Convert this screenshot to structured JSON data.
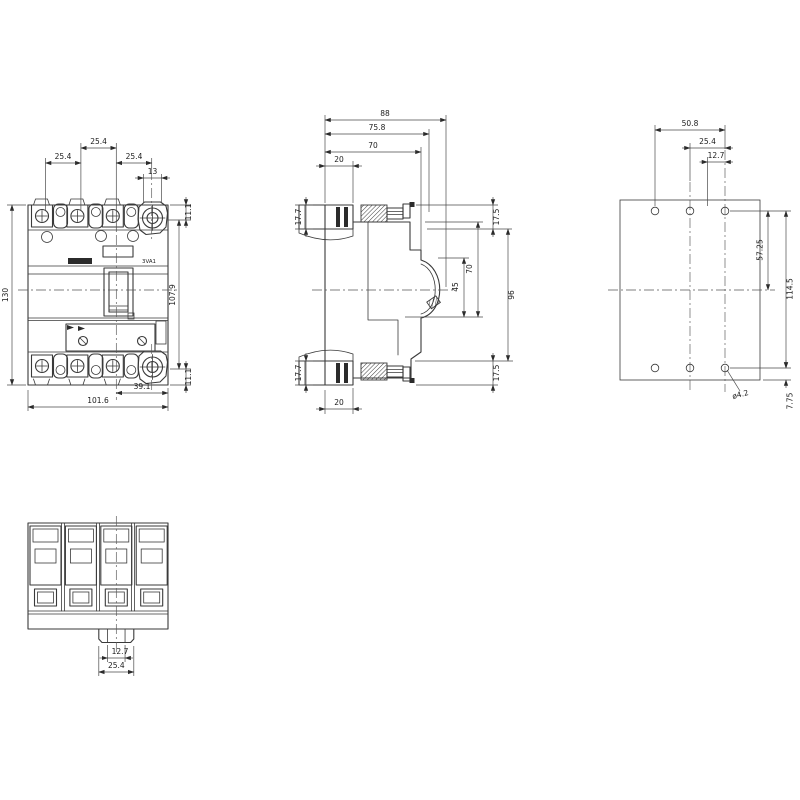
{
  "drawing": {
    "product_label": "3VA1",
    "front": {
      "pitch_left": "25.4",
      "pitch_mid": "25.4",
      "pitch_right": "25.4",
      "clamp_width": "13",
      "top_offset": "11.1",
      "terminal_span": "107.9",
      "bottom_offset": "11.1",
      "body_height": "130",
      "handle_to_edge": "39.1",
      "body_width": "101.6"
    },
    "side": {
      "depth_total": "88",
      "depth_to_screw": "75.8",
      "depth_case": "70",
      "top_step": "20",
      "lug_left_top": "17.7",
      "lug_left_bottom": "17.7",
      "lug_right_top": "17.5",
      "lug_right_bottom": "17.5",
      "front_span": "70",
      "handle_span": "45",
      "case_span": "96",
      "bottom_step": "20"
    },
    "rear": {
      "hole_span_h": "50.8",
      "hole_pitch": "25.4",
      "hole_half_pitch": "12.7",
      "hole_to_center": "57.25",
      "hole_span_v": "114.5",
      "hole_to_edge": "7.75",
      "hole_diameter": "ø4.2"
    },
    "bottom": {
      "slot_width": "12.7",
      "tab_width": "25.4"
    }
  }
}
